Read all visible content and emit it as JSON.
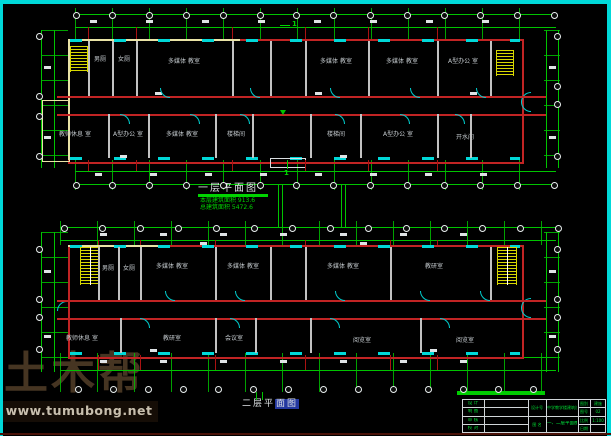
{
  "watermark": {
    "logo": "土木帮",
    "url": "www.tumubong.net"
  },
  "plan1": {
    "title": "一层平面图",
    "stats": [
      "本层建筑面积 913.6",
      "总建筑面积 5472.6"
    ],
    "section_label": "1",
    "north_rooms": [
      "男厕",
      "女厕",
      "多媒体 教室",
      "多媒体 教室",
      "多媒体 教室",
      "A型办公 室"
    ],
    "south_rooms": [
      "教师休息 室",
      "A型办公 室",
      "多媒体 教室",
      "楼梯间",
      "楼梯间",
      "A型办公 室",
      "开水间"
    ]
  },
  "plan2": {
    "title_main": "二层平",
    "title_highlight": "面图",
    "north_rooms": [
      "男厕",
      "女厕",
      "多媒体 教室",
      "多媒体 教室",
      "多媒体 教室",
      "教研室"
    ],
    "south_rooms": [
      "教师休息 室",
      "教研室",
      "会议室",
      "阅览室",
      "阅览室"
    ]
  },
  "title_block": {
    "left_rows": [
      "设 计",
      "制 图",
      "审 核",
      "校 对"
    ],
    "mid_top": "设计号",
    "mid_bottom": "图 名",
    "project": "中学教学楼建筑设计",
    "drawing": "一、二层平面图",
    "right_rows": [
      "图别",
      "图号",
      "比例",
      "日期"
    ],
    "right_values": [
      "建施",
      "02",
      "1:100",
      ""
    ]
  },
  "colors": {
    "dimension_green": "#00c400",
    "wall_red": "#c22424",
    "detail_cyan": "#00d8d8",
    "stair_yellow": "#d8d800",
    "frame_cyan": "#00d9d9",
    "watermark_brown": "#463522",
    "title_highlight_blue": "#2438a0"
  }
}
